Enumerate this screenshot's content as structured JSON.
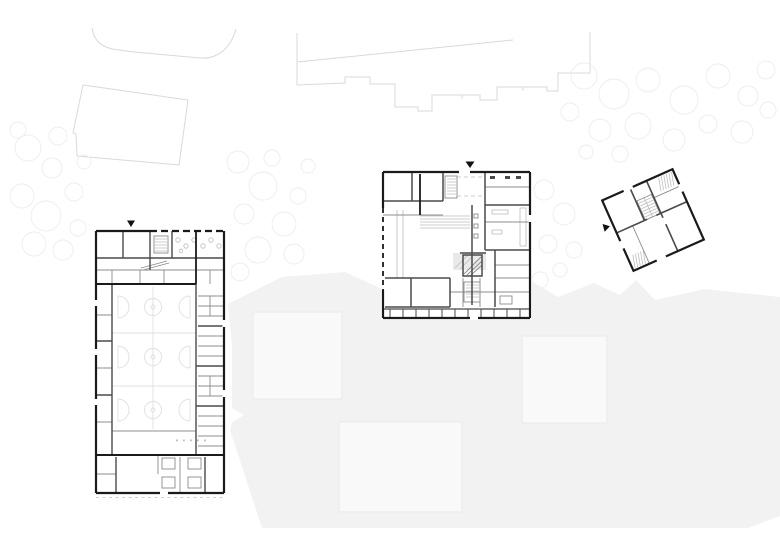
{
  "canvas": {
    "width": 780,
    "height": 552,
    "background": "#ffffff"
  },
  "colors": {
    "wall": "#1a1a1a",
    "inner_wall": "#4a4a4a",
    "partition": "#8c8c8c",
    "fine_line": "#bdbdbd",
    "court_line": "#e0e0e0",
    "context_line": "#d9d9d9",
    "vegetation_line": "#ededed",
    "ground_fill": "#f2f2f3",
    "pad_fill": "#f9f9fa",
    "pad_stroke": "#e9e9ea",
    "stage_fill": "#e9e9e9",
    "plan_bg": "#ffffff",
    "marker": "#111111"
  },
  "scene": {
    "type": "architectural-site-plan",
    "buildings": [
      {
        "id": "building-left"
      },
      {
        "id": "building-center"
      },
      {
        "id": "building-right"
      }
    ],
    "entry_markers": 3,
    "ground_pads": 3
  },
  "icons": {
    "entry_arrow": "▼"
  }
}
